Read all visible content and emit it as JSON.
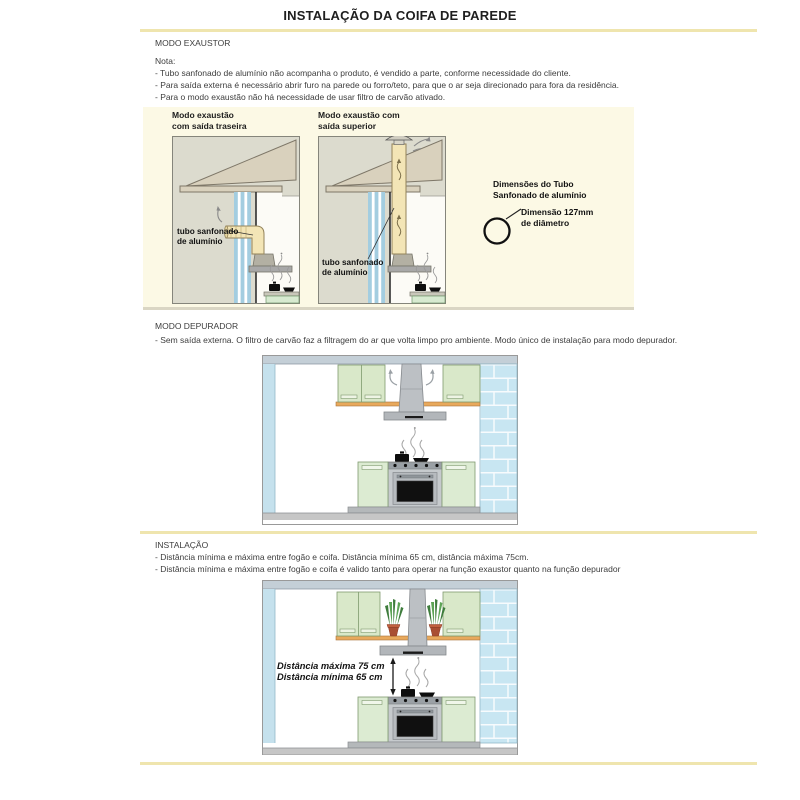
{
  "page": {
    "title": "INSTALAÇÃO DA COIFA DE PAREDE"
  },
  "sections": {
    "exaustor": {
      "heading": "MODO EXAUSTOR",
      "note_label": "Nota:",
      "notes": [
        "- Tubo sanfonado de alumínio não acompanha o produto, é vendido a parte, conforme necessidade do cliente.",
        "- Para saída externa é necessário abrir furo na parede ou forro/teto, para que o ar seja direcionado para fora da residência.",
        "- Para o modo exaustão não há necessidade de usar filtro de carvão ativado."
      ]
    },
    "depurador": {
      "heading": "MODO DEPURADOR",
      "note": "- Sem saída externa. O filtro de carvão faz a filtragem do ar que volta limpo pro ambiente. Modo único de instalação para modo depurador."
    },
    "instalacao": {
      "heading": "INSTALAÇÃO",
      "notes": [
        "- Distância mínima e máxima entre fogão e coifa. Distância mínima 65 cm, distância máxima 75cm.",
        "- Distância mínima e máxima entre fogão e coifa é valido tanto para operar na função exaustor quanto na função depurador"
      ]
    }
  },
  "exhaust_panel": {
    "rear_outlet_title": "Modo exaustão\ncom saída traseira",
    "top_outlet_title": "Modo exaustão com\nsaída superior",
    "duct_label": "tubo sanfonado\nde alumínio",
    "dimensions_heading": "Dimensões do Tubo\nSanfonado de alumínio",
    "dimensions_value": "Dimensão 127mm\nde diâmetro"
  },
  "installation_diagram": {
    "distance_max_label": "Distância máxima 75 cm",
    "distance_min_label": "Distância mínima 65 cm"
  },
  "colors": {
    "accent_rule": "#efe5ae",
    "panel_background": "#fcf9e5",
    "house_exterior": "#dcdbce",
    "roof_tan": "#d9d1bd",
    "duct_tan": "#f3e5b6",
    "wall_blue": "#a3cde0",
    "cabinet_green": "#d9e8c9",
    "brick_blue": "#c8e6f2",
    "steel_gray": "#c6cacd",
    "wood_shelf": "#e8a95c"
  }
}
